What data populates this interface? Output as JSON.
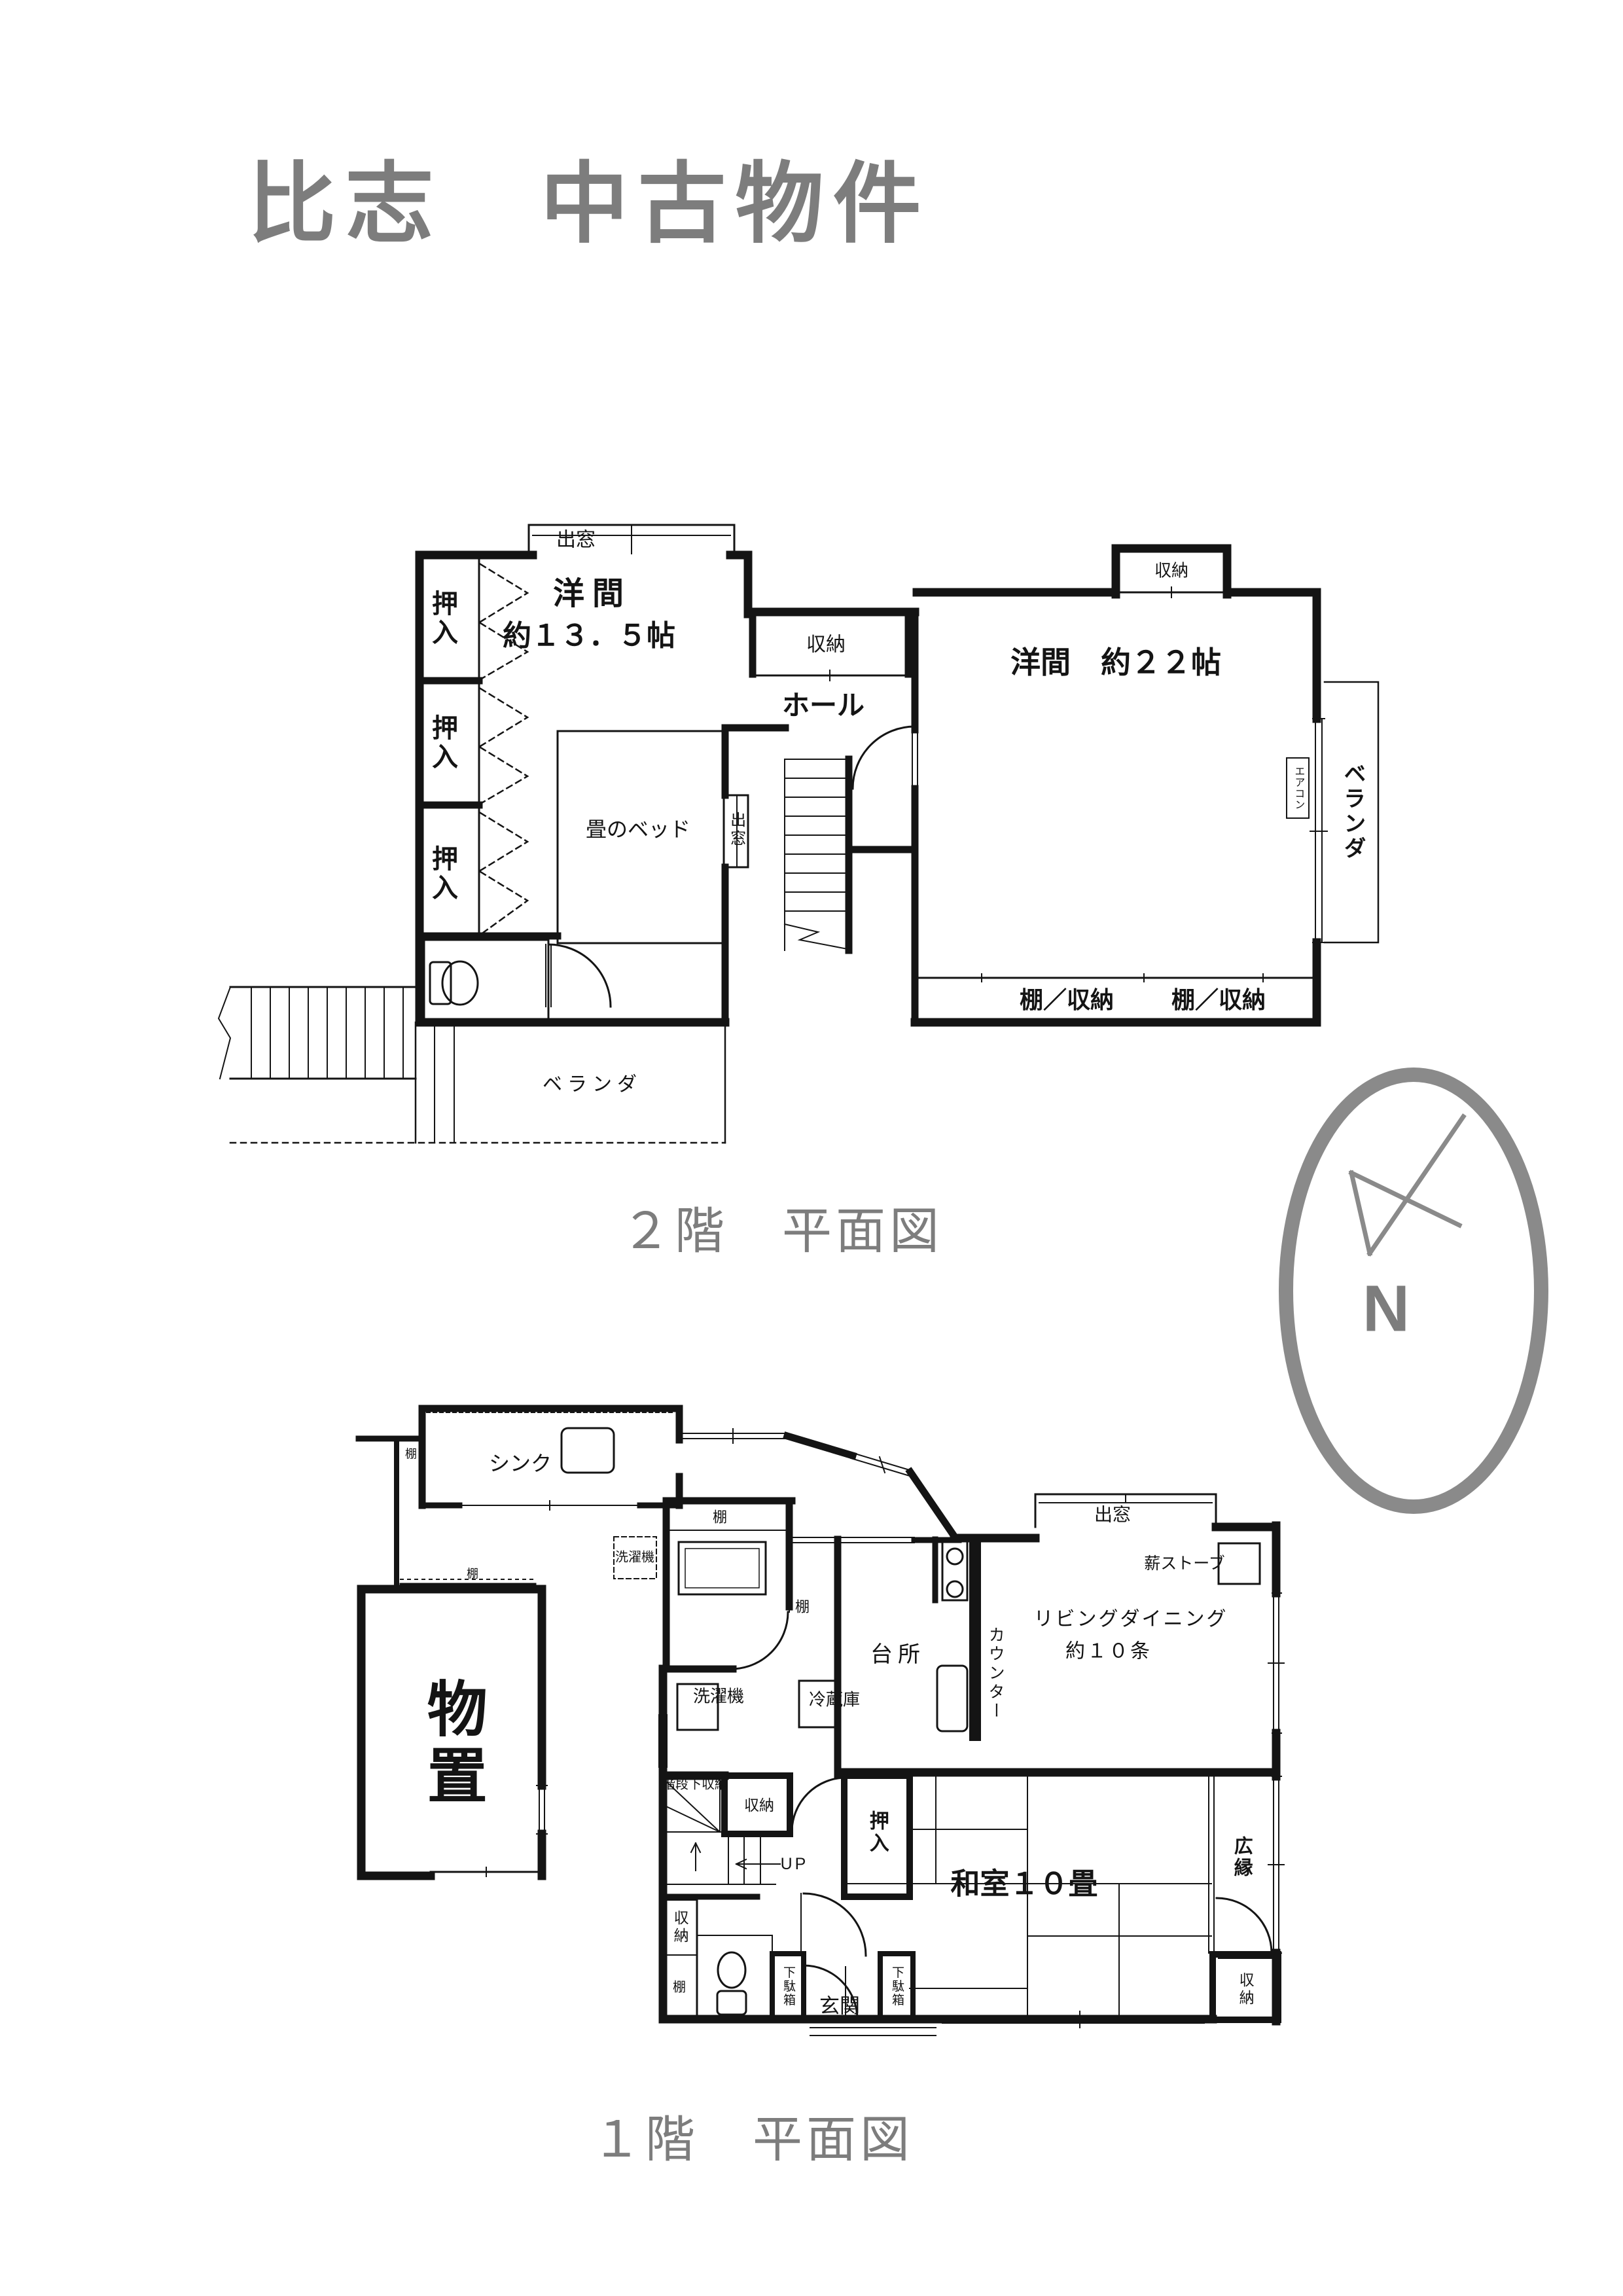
{
  "palette": {
    "ink": "#141414",
    "gray": "#7d7d7d"
  },
  "title": "比志　中古物件",
  "compass": {
    "north_label": "N"
  },
  "floor2": {
    "caption": "２階　平面図",
    "labels": {
      "bay_top": "出窓",
      "room_west_name": "洋間",
      "room_west_size": "約１３．５帖",
      "closet1": "押入",
      "closet2": "押入",
      "closet3": "押入",
      "tatami_bed": "畳のベッド",
      "bay_side": "出窓",
      "hall": "ホール",
      "hall_closet": "収納",
      "room_east": "洋間　約２２帖",
      "east_closet": "収納",
      "aircon": "エアコン",
      "veranda_east": "ベランダ",
      "shelf_storage_left": "棚／収納",
      "shelf_storage_right": "棚／収納",
      "veranda_south": "ベランダ"
    }
  },
  "floor1": {
    "caption": "１階　平面図",
    "labels": {
      "sink": "シンク",
      "shelf_nook": "棚",
      "shelf_corridor": "棚",
      "storage_shed": "物置",
      "washer_outdoor": "洗濯機",
      "utility_shelf": "棚",
      "side_shelf": "棚",
      "washer": "洗濯機",
      "fridge": "冷蔵庫",
      "kitchen": "台所",
      "counter": "カウンター",
      "living_name": "リビングダイニング",
      "living_size": "約１０条",
      "wood_stove": "薪ストーブ",
      "bay_window": "出窓",
      "under_stair_storage": "階段下収納",
      "stair_storage": "収納",
      "up": "UP",
      "storage_left": "収納",
      "shelf_left": "棚",
      "shoe_box1": "下駄箱",
      "entrance": "玄関",
      "shoe_box2": "下駄箱",
      "closet": "押入",
      "washitsu": "和室１０畳",
      "hiroen": "広縁",
      "storage_se": "収納"
    }
  }
}
